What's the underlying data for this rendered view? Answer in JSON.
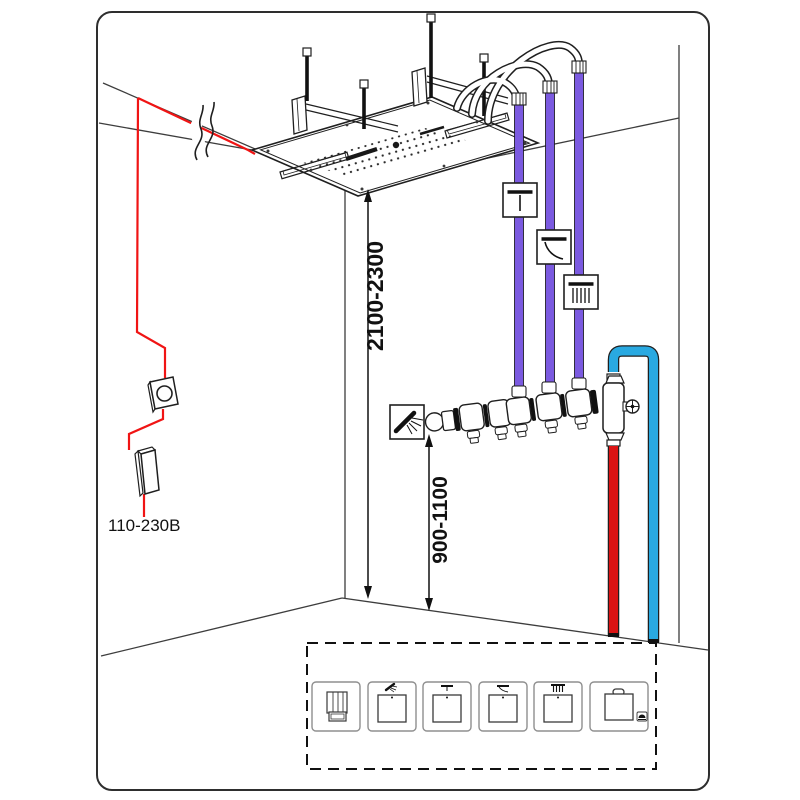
{
  "labels": {
    "ceiling_height_range": "2100-2300",
    "valve_height_range": "900-1100",
    "power_rating": "110-230В"
  },
  "colors": {
    "pipe_purple": "#7B5AE0",
    "pipe_blue": "#29A9E1",
    "pipe_red": "#DB1414",
    "wire_red": "#F01414"
  },
  "icons": {
    "pipe_1": "waterfall-icon",
    "pipe_2": "stream-icon",
    "pipe_3": "rain-icon",
    "manifold": "hand-shower-icon"
  },
  "legend_modules": [
    {
      "name": "control-knob-module"
    },
    {
      "name": "hand-shower-module"
    },
    {
      "name": "waterfall-module"
    },
    {
      "name": "stream-module"
    },
    {
      "name": "rain-module"
    },
    {
      "name": "light-module"
    }
  ]
}
